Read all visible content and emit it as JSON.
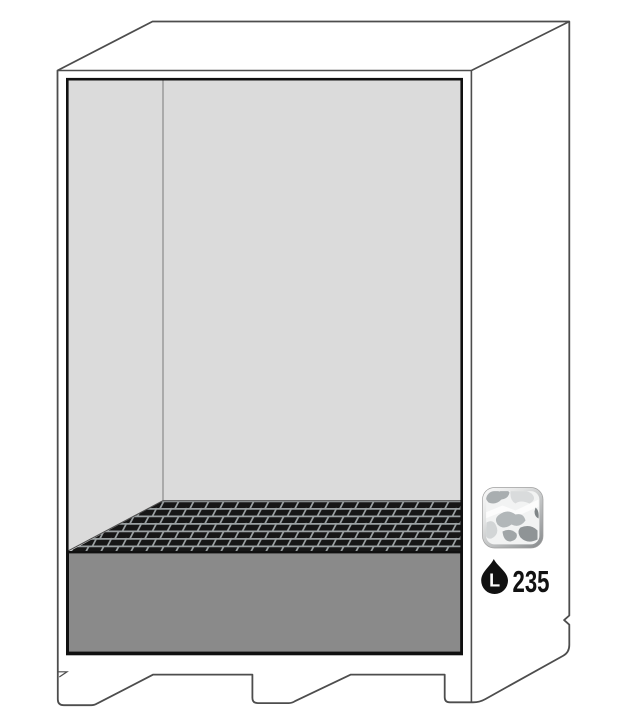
{
  "page": {
    "background": "#ffffff"
  },
  "illustration": {
    "subject": "safety-storage-cabinet-open-with-grating-and-spill-sump",
    "capacity": {
      "value": "235",
      "unit": "L"
    },
    "colors": {
      "outline": "#4d4d4d",
      "opening_border": "#101010",
      "interior_wall": "#dbdbdb",
      "sump": "#8a8a8a",
      "grating_base": "#161616",
      "grating_lines": "#9aa0a2",
      "label_text": "#111111"
    },
    "icons": [
      {
        "name": "sump-tray-texture-icon",
        "depicts": "rounded square with gray crumpled texture"
      },
      {
        "name": "liquid-droplet-icon",
        "depicts": "black droplet holding letter L (litres)"
      }
    ]
  }
}
